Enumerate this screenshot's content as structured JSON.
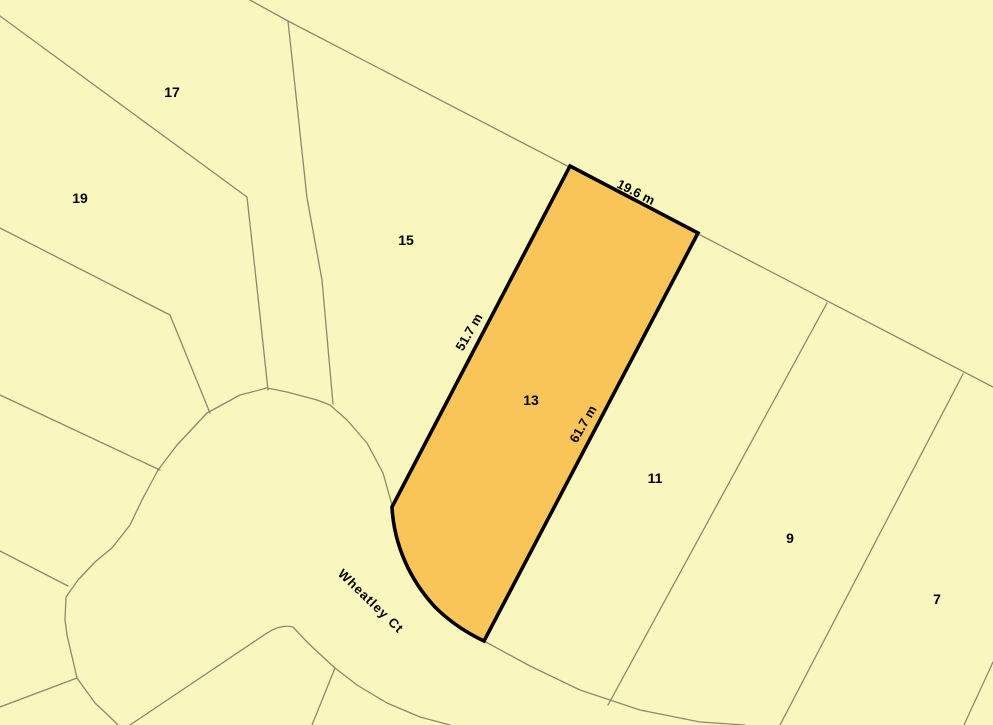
{
  "map": {
    "street": {
      "label": "Wheatley Ct"
    },
    "parcels": [
      {
        "lot": "17"
      },
      {
        "lot": "19"
      },
      {
        "lot": "15"
      },
      {
        "lot": "13",
        "highlighted": true
      },
      {
        "lot": "11"
      },
      {
        "lot": "9"
      },
      {
        "lot": "7"
      }
    ],
    "selected_parcel": {
      "lot": "13",
      "dimensions": [
        {
          "label": "19.6 m",
          "edge": "north"
        },
        {
          "label": "51.7 m",
          "edge": "west"
        },
        {
          "label": "61.7 m",
          "edge": "east"
        }
      ]
    },
    "colors": {
      "parcel_fill": "#F9F7BE",
      "selected_fill": "#FAC558",
      "selected_outline": "#000000",
      "boundary_line": "#8A8A70",
      "label_color": "#000000"
    }
  }
}
